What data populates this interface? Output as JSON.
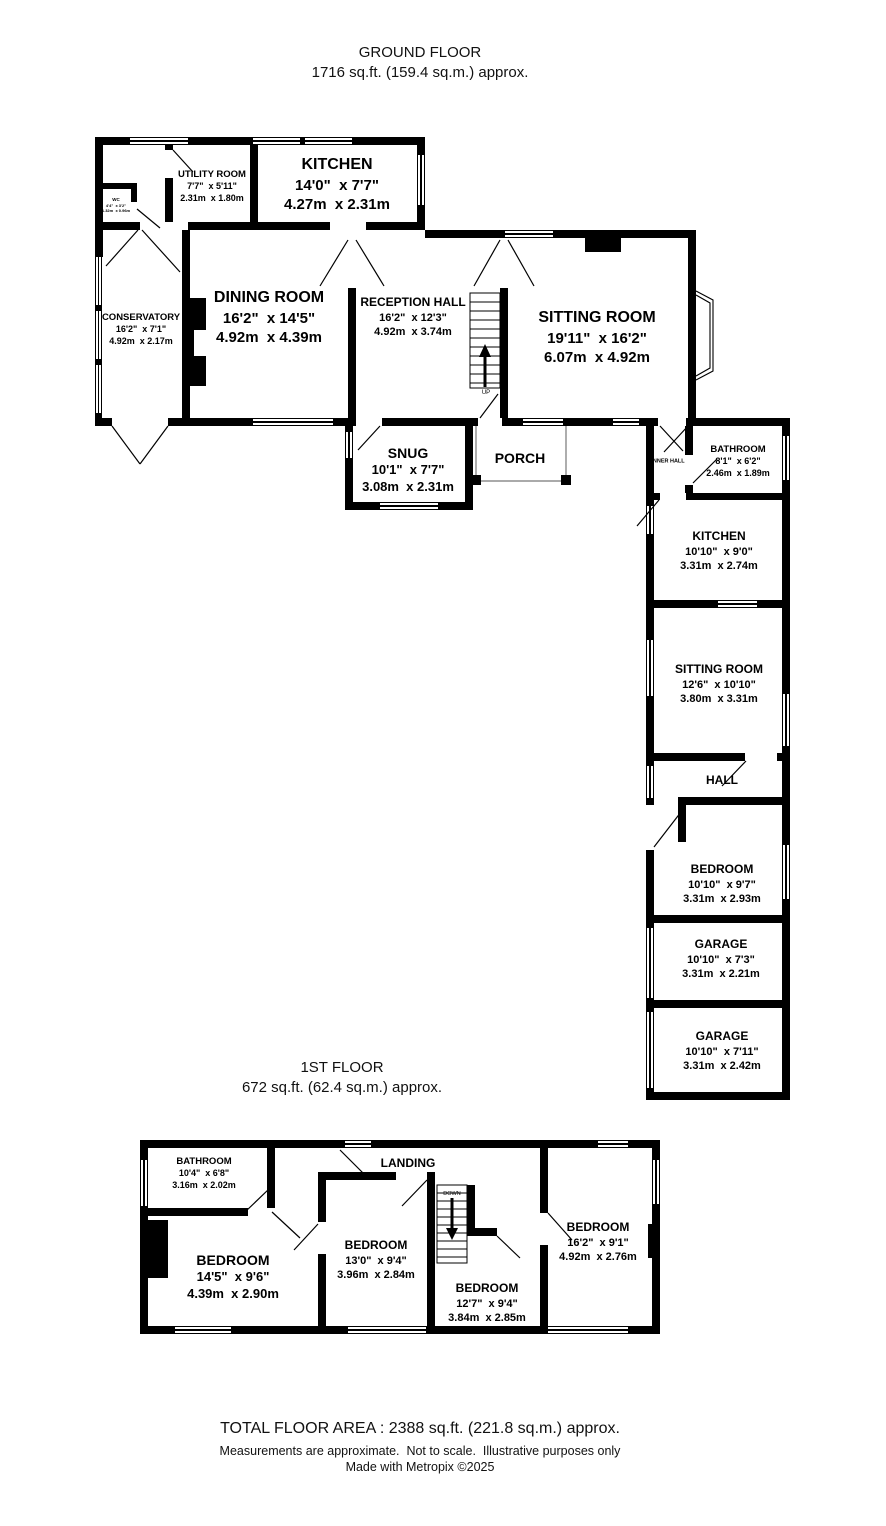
{
  "titles": {
    "ground_line1": "GROUND FLOOR",
    "ground_line2": "1716 sq.ft. (159.4 sq.m.) approx.",
    "first_line1": "1ST FLOOR",
    "first_line2": "672 sq.ft. (62.4 sq.m.) approx."
  },
  "footer": {
    "total": "TOTAL FLOOR AREA : 2388 sq.ft. (221.8 sq.m.) approx.",
    "disclaimer": "Measurements are approximate.  Not to scale.  Illustrative purposes only",
    "credit": "Made with Metropix ©2025"
  },
  "stairs": {
    "up": "UP",
    "down": "DOWN"
  },
  "rooms": {
    "kitchen_main": {
      "name": "KITCHEN",
      "imperial": "14'0\"  x 7'7\"",
      "metric": "4.27m  x 2.31m"
    },
    "utility": {
      "name": "UTILITY ROOM",
      "imperial": "7'7\"  x 5'11\"",
      "metric": "2.31m  x 1.80m"
    },
    "wc": {
      "name": "WC",
      "imperial": "4'4\"  x 3'2\"",
      "metric": "1.32m  x 0.96m"
    },
    "conservatory": {
      "name": "CONSERVATORY",
      "imperial": "16'2\"  x 7'1\"",
      "metric": "4.92m  x 2.17m"
    },
    "dining": {
      "name": "DINING ROOM",
      "imperial": "16'2\"  x 14'5\"",
      "metric": "4.92m  x 4.39m"
    },
    "reception": {
      "name": "RECEPTION HALL",
      "imperial": "16'2\"  x 12'3\"",
      "metric": "4.92m  x 3.74m"
    },
    "sitting_main": {
      "name": "SITTING ROOM",
      "imperial": "19'11\"  x 16'2\"",
      "metric": "6.07m  x 4.92m"
    },
    "snug": {
      "name": "SNUG",
      "imperial": "10'1\"  x 7'7\"",
      "metric": "3.08m  x 2.31m"
    },
    "porch": {
      "name": "PORCH"
    },
    "inner_hall": {
      "name": "INNER HALL"
    },
    "bathroom_gf": {
      "name": "BATHROOM",
      "imperial": "8'1\"  x 6'2\"",
      "metric": "2.46m  x 1.89m"
    },
    "kitchen_annex": {
      "name": "KITCHEN",
      "imperial": "10'10\"  x 9'0\"",
      "metric": "3.31m  x 2.74m"
    },
    "sitting_annex": {
      "name": "SITTING ROOM",
      "imperial": "12'6\"  x 10'10\"",
      "metric": "3.80m  x 3.31m"
    },
    "hall": {
      "name": "HALL"
    },
    "bedroom_gf": {
      "name": "BEDROOM",
      "imperial": "10'10\"  x 9'7\"",
      "metric": "3.31m  x 2.93m"
    },
    "garage1": {
      "name": "GARAGE",
      "imperial": "10'10\"  x 7'3\"",
      "metric": "3.31m  x 2.21m"
    },
    "garage2": {
      "name": "GARAGE",
      "imperial": "10'10\"  x 7'11\"",
      "metric": "3.31m  x 2.42m"
    },
    "bathroom_ff": {
      "name": "BATHROOM",
      "imperial": "10'4\"  x 6'8\"",
      "metric": "3.16m  x 2.02m"
    },
    "landing": {
      "name": "LANDING"
    },
    "bedroom_ff_left": {
      "name": "BEDROOM",
      "imperial": "14'5\"  x 9'6\"",
      "metric": "4.39m  x 2.90m"
    },
    "bedroom_ff_mid": {
      "name": "BEDROOM",
      "imperial": "13'0\"  x 9'4\"",
      "metric": "3.96m  x 2.84m"
    },
    "bedroom_ff_bottom": {
      "name": "BEDROOM",
      "imperial": "12'7\"  x 9'4\"",
      "metric": "3.84m  x 2.85m"
    },
    "bedroom_ff_right": {
      "name": "BEDROOM",
      "imperial": "16'2\"  x 9'1\"",
      "metric": "4.92m  x 2.76m"
    }
  }
}
